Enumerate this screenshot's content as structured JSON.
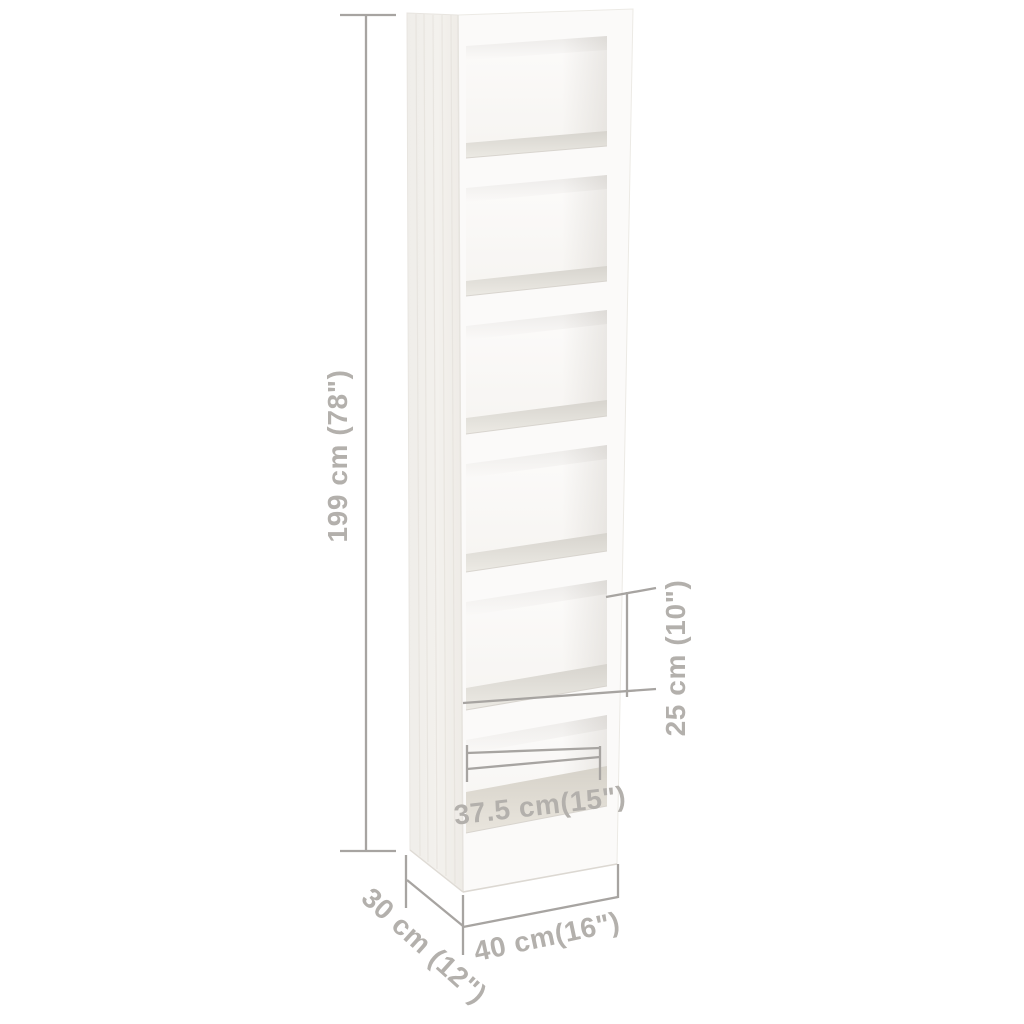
{
  "diagram": {
    "description": "bookcase-dimension-diagram",
    "shelf_compartments": 6,
    "dimensions": {
      "height": "199 cm (78\")",
      "shelf_spacing": "25 cm (10\")",
      "inner_width": "37.5 cm(15\")",
      "width": "40 cm(16\")",
      "depth": "30 cm (12\")"
    },
    "colors": {
      "background": "#ffffff",
      "dimension_line": "#a7a4a1",
      "dimension_text": "#b3b0ac",
      "furniture_front": "#fbfaf9",
      "furniture_side": "#f1efeb",
      "shelf_surface_dark": "#d7d4ce",
      "shelf_surface_light": "#eceae4"
    }
  }
}
